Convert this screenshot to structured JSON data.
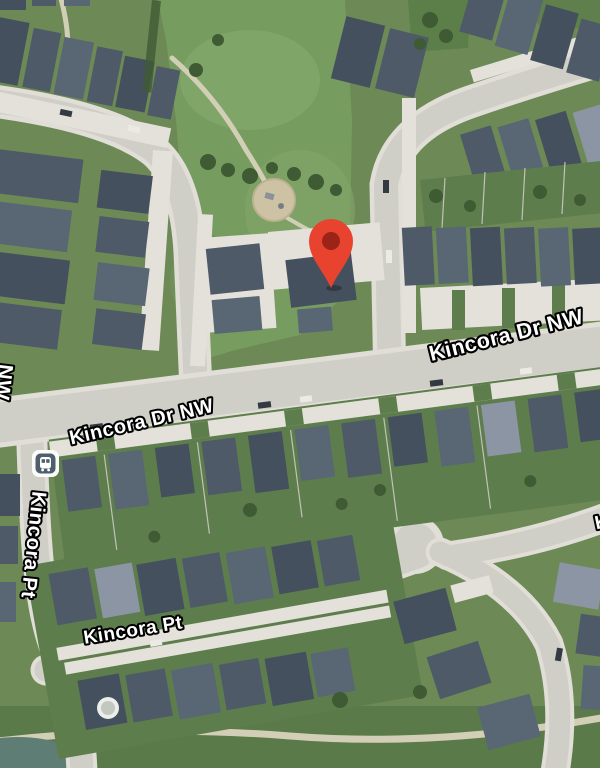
{
  "map": {
    "labels": {
      "kincora_dr_left": "Kincora Dr NW",
      "kincora_dr_right": "Kincora Dr NW",
      "kincora_pt_vertical": "Kincora Pt",
      "kincora_pt_horizontal": "Kincora Pt",
      "nw_partial_left": "NW",
      "partial_right": "K"
    },
    "marker": {
      "color": "#E8432F",
      "inner_color": "#9B2417"
    },
    "transit_stop": {
      "bg": "#FBFBFA",
      "fg": "#4D5F6D"
    }
  }
}
